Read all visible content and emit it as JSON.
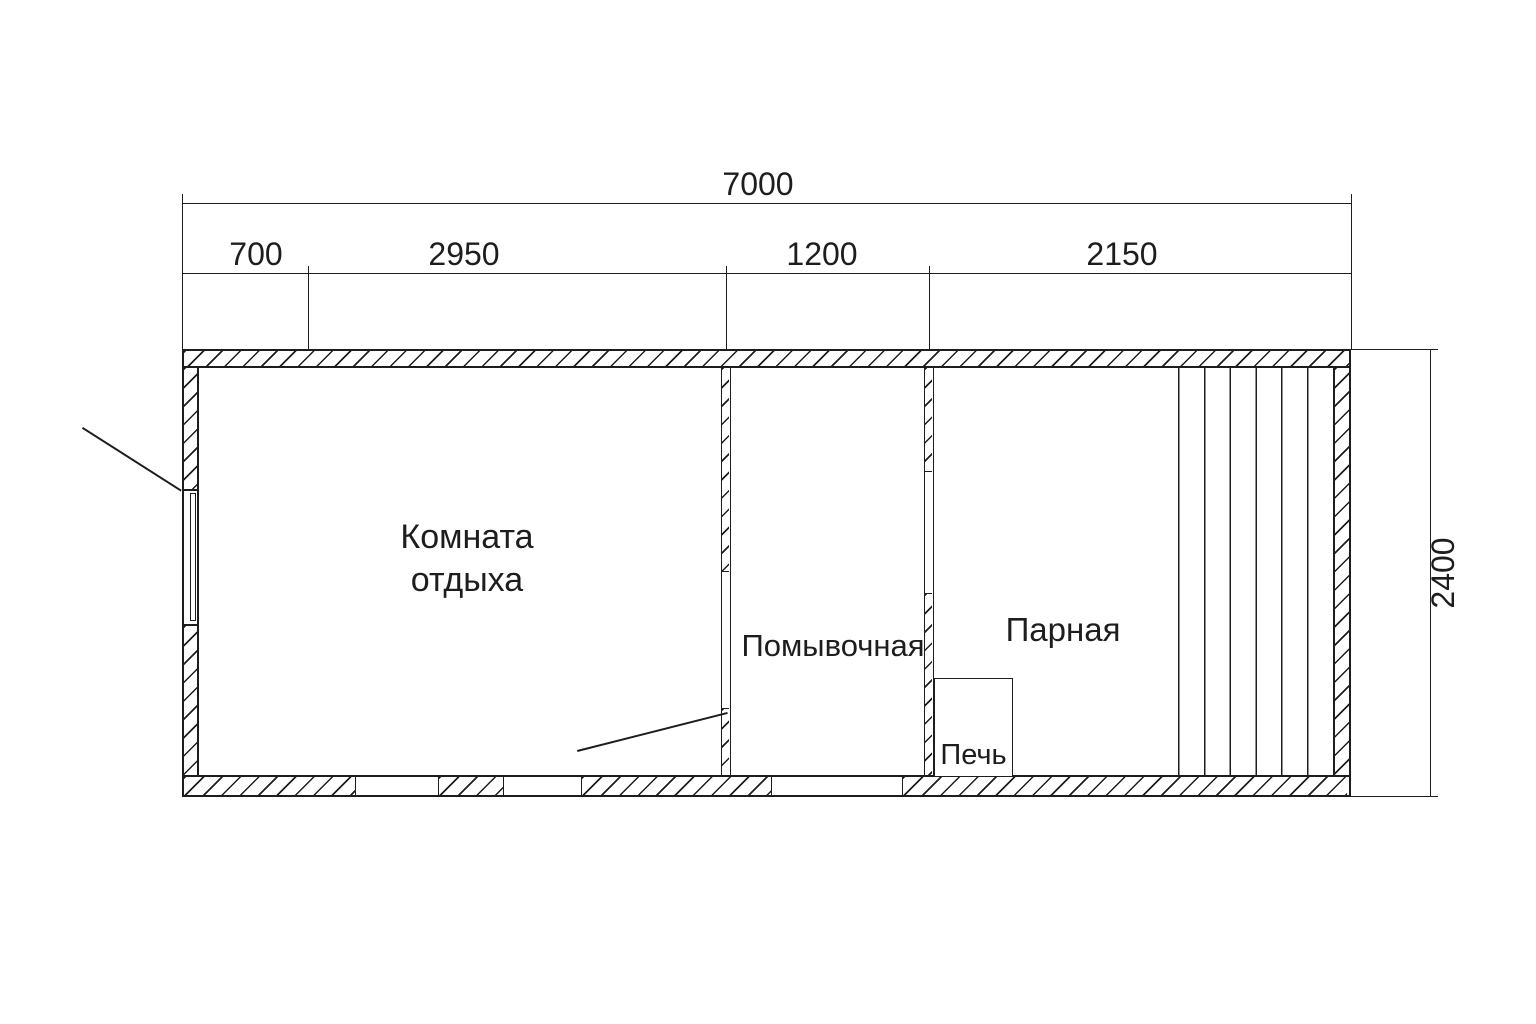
{
  "plan": {
    "background": "#ffffff",
    "line_color": "#1d1d1d",
    "rooms": {
      "rest": {
        "name": "Комната отдыха",
        "lines": [
          "Комната",
          "отдыха"
        ]
      },
      "wash": {
        "name": "Помывочная"
      },
      "steam": {
        "name": "Парная"
      },
      "stove": {
        "name": "Печь"
      }
    },
    "dimensions": {
      "overall_width": "7000",
      "segments": [
        "700",
        "2950",
        "1200",
        "2150"
      ],
      "overall_depth": "2400"
    }
  }
}
